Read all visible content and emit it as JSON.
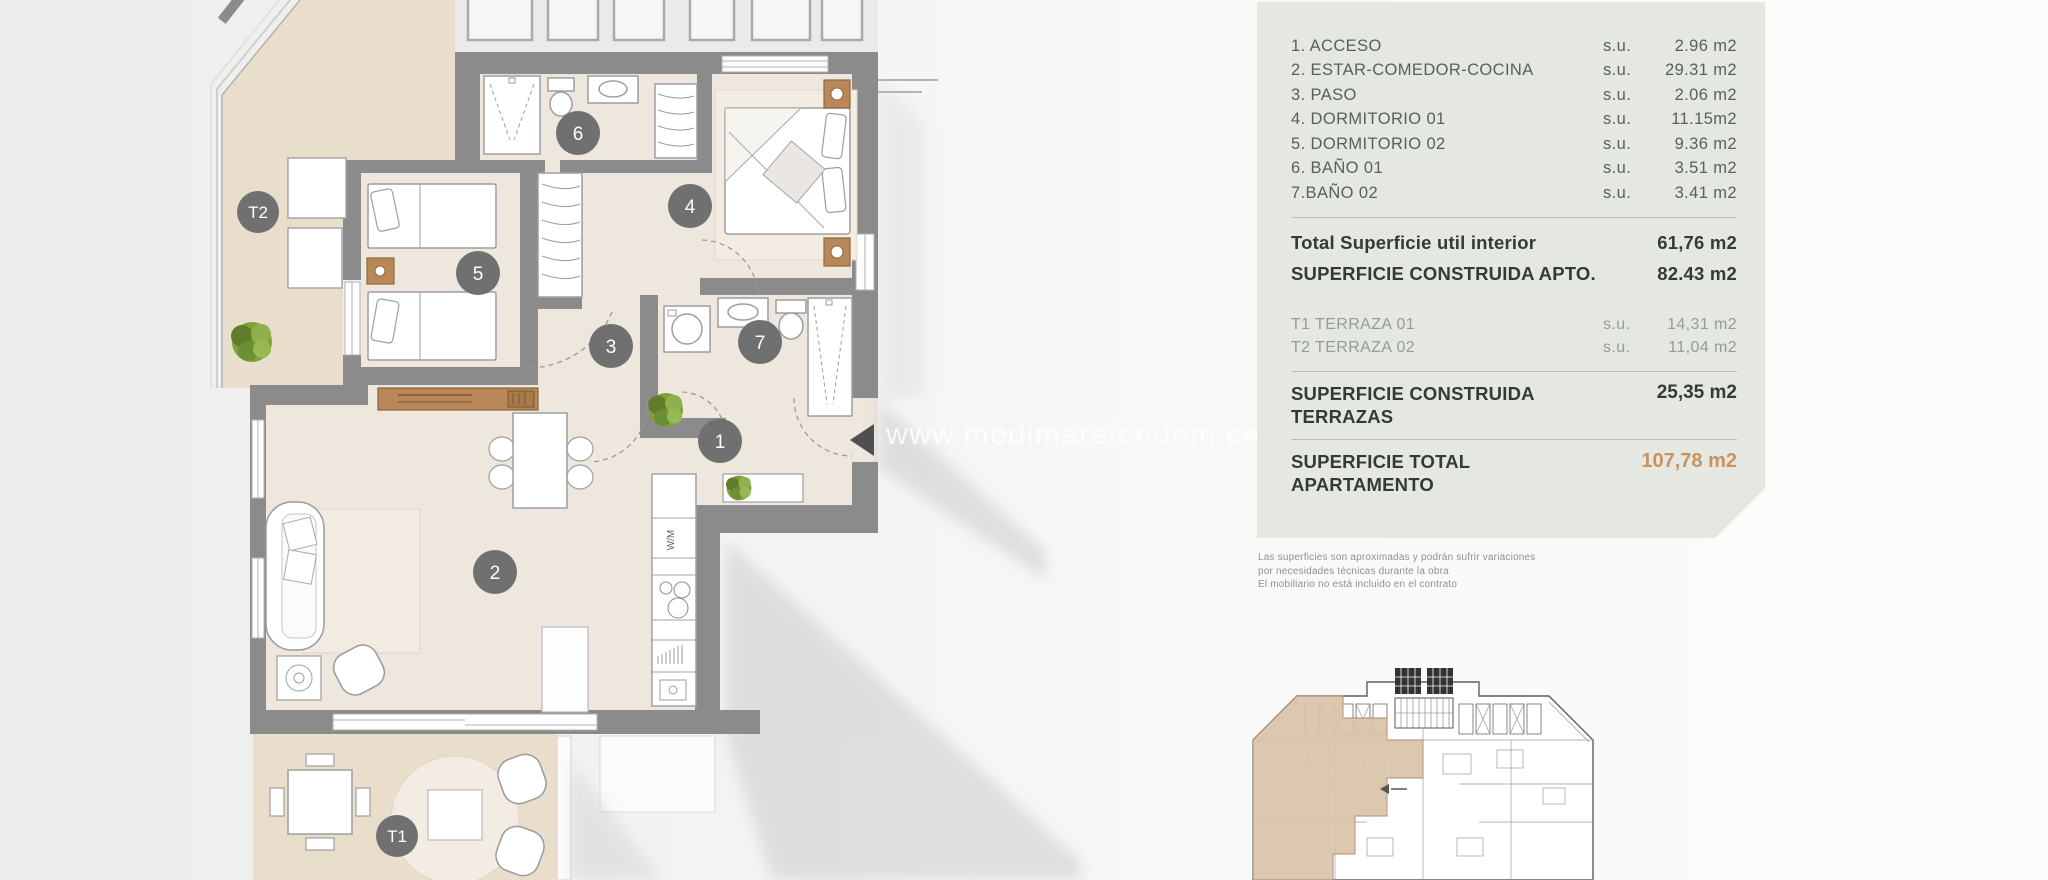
{
  "panel": {
    "rows": [
      {
        "label": "1. ACCESO",
        "su": "s.u.",
        "value": "2.96 m2"
      },
      {
        "label": "2. ESTAR-COMEDOR-COCINA",
        "su": "s.u.",
        "value": "29.31 m2"
      },
      {
        "label": "3. PASO",
        "su": "s.u.",
        "value": "2.06 m2"
      },
      {
        "label": "4. DORMITORIO 01",
        "su": "s.u.",
        "value": "11.15m2"
      },
      {
        "label": "5. DORMITORIO 02",
        "su": "s.u.",
        "value": "9.36 m2"
      },
      {
        "label": "6. BAÑO 01",
        "su": "s.u.",
        "value": "3.51 m2"
      },
      {
        "label": "7.BAÑO 02",
        "su": "s.u.",
        "value": "3.41 m2"
      }
    ],
    "totals": [
      {
        "label": "Total Superficie util interior",
        "value": "61,76 m2"
      },
      {
        "label": "SUPERFICIE CONSTRUIDA APTO.",
        "value": "82.43 m2"
      }
    ],
    "terraces": [
      {
        "label": "T1 TERRAZA 01",
        "su": "s.u.",
        "value": "14,31 m2"
      },
      {
        "label": "T2 TERRAZA 02",
        "su": "s.u.",
        "value": "11,04 m2"
      }
    ],
    "terrace_total": {
      "label_line1": "SUPERFICIE CONSTRUIDA",
      "label_line2": "TERRAZAS",
      "value": "25,35 m2"
    },
    "apartment_total": {
      "label_line1": "SUPERFICIE TOTAL",
      "label_line2": "APARTAMENTO",
      "value": "107,78 m2"
    },
    "colors": {
      "background": "#e4e8e0",
      "text": "#4d574f",
      "heading": "#333b34",
      "muted": "#949c94",
      "accent": "#c8935f"
    }
  },
  "disclaimer": {
    "lines": [
      "Las superficies son aproximadas y podrán sufrir variaciones",
      "por necesidades técnicas durante la obra",
      "El mobiliario no está incluido en el contrato"
    ]
  },
  "watermark": {
    "text": "www.medimareiendom.com"
  },
  "plan": {
    "room_labels": {
      "r1": "1",
      "r2": "2",
      "r3": "3",
      "r4": "4",
      "r5": "5",
      "r6": "6",
      "r7": "7",
      "t1": "T1",
      "t2": "T2"
    },
    "kitchen_appliance_label": "W/M",
    "colors": {
      "wall": "#8b8b8b",
      "floor": "#eee7de",
      "terrace": "#e9ddcc",
      "wood": "#b8885a",
      "label_circle": "#707070",
      "plant": "#7ca13d"
    }
  }
}
